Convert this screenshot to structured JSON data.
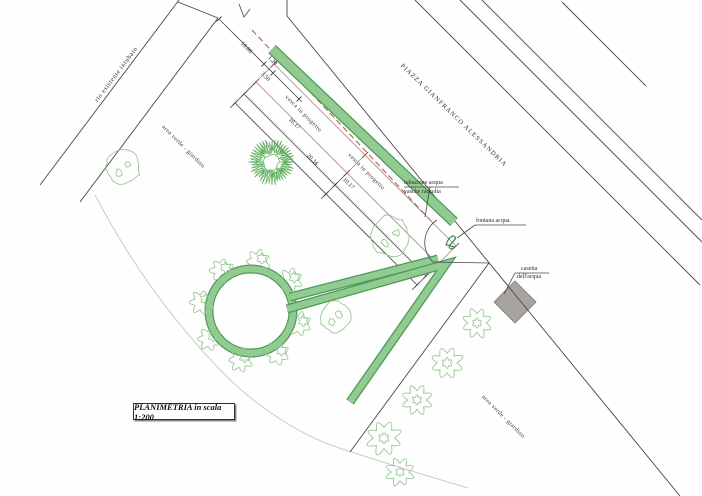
{
  "title_box": {
    "text": "PLANIMETRIA in scala 1:200"
  },
  "labels": {
    "rio": "rio esistente intubato",
    "piazza": "PIAZZA GIANFRANCO ALESSANDRIA",
    "area_verde_left": "area verde - giardino",
    "area_verde_right": "area verde - giardino",
    "vasca_1": "vasca in progetto",
    "vasca_2": "vasca in progetto",
    "tubazione": "tubazione acqua",
    "vasche_raccolta": "vasche raccolta",
    "fontana": "fontana acqua",
    "casetta_line1": "casetta",
    "casetta_line2": "dell'acqua"
  },
  "dimensions": {
    "d10_00": "10.00",
    "d1_20": "1.20",
    "d3_50": "3.50",
    "d10_17_a": "10.17",
    "d20_34": "20.34",
    "d10_17_b": "10.17"
  },
  "colors": {
    "road": "#474745",
    "text": "#2d2d2d",
    "green_edge": "#4c9a55",
    "green_fill": "#92cb92",
    "tree_outline": "#96c990",
    "spiky_tree": "#5fae5f",
    "red_dash": "#b45f50",
    "rect_edge": "#a08b8d",
    "tick_red": "#b0483a",
    "casetta_fill": "#a7a49d",
    "casetta_edge": "#7f7c76",
    "faint": "#cbcbc6",
    "glyph": "#3d8a4f"
  },
  "plan": {
    "trees": [
      {
        "x": 123,
        "y": 167,
        "r": 17,
        "style": "round"
      },
      {
        "x": 390,
        "y": 236,
        "r": 20,
        "style": "round"
      },
      {
        "x": 335,
        "y": 317,
        "r": 15,
        "style": "round"
      },
      {
        "x": 477,
        "y": 323,
        "r": 15,
        "style": "lobed"
      },
      {
        "x": 447,
        "y": 363,
        "r": 16,
        "style": "lobed"
      },
      {
        "x": 417,
        "y": 400,
        "r": 15,
        "style": "lobed"
      },
      {
        "x": 384,
        "y": 438,
        "r": 17,
        "style": "lobed"
      },
      {
        "x": 400,
        "y": 472,
        "r": 14,
        "style": "lobed"
      }
    ],
    "ring": {
      "cx": 251,
      "cy": 311,
      "band_r": 42,
      "bush_r": 12,
      "bush_ring_r": 50,
      "bush_angles": [
        15,
        58,
        102,
        146,
        190,
        234,
        278,
        322
      ]
    },
    "spiky_tree": {
      "x": 272,
      "y": 162,
      "r": 22
    }
  }
}
